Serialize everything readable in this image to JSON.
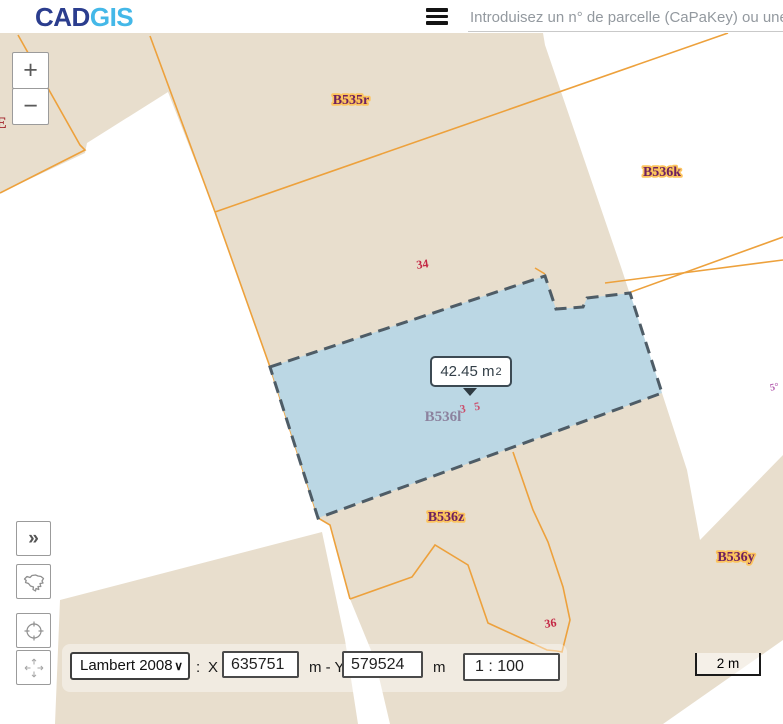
{
  "header": {
    "logo": {
      "part1": "CAD",
      "part2": "GIS"
    },
    "search": {
      "placeholder": "Introduisez un n° de parcelle (CaPaKey) ou une",
      "value": ""
    }
  },
  "map": {
    "colors": {
      "parcel_fill": "#e8decd",
      "boundary_line": "#eda13c",
      "selection_fill": "#b7d6e5",
      "selection_border": "#4e5c66",
      "parcel_label": "#6d2060",
      "parcel_label_halo": "#fcc45e",
      "house_number": "#c42845"
    },
    "parcel_labels": [
      {
        "text": "B535r"
      },
      {
        "text": "B536k"
      },
      {
        "text": "B536z"
      },
      {
        "text": "B536y"
      }
    ],
    "selected_parcel": {
      "label": "B536l",
      "tooltip": {
        "value": "42.45 m",
        "sup": "2"
      }
    },
    "house_numbers": [
      {
        "text": "34"
      },
      {
        "text": "3 5"
      },
      {
        "text": "36"
      },
      {
        "text": "5°"
      },
      {
        "text": "E"
      }
    ]
  },
  "controls": {
    "zoom_in": "+",
    "zoom_out": "−",
    "expand": "»"
  },
  "bottom_bar": {
    "crs": "Lambert 2008",
    "chevron": "∨",
    "colon": ":",
    "x_label": "X",
    "x_value": "635751",
    "y_label": "m - Y",
    "y_value": "579524",
    "unit": "m",
    "scale_value": "1 : 100"
  },
  "scale_bar": {
    "label": "2 m"
  }
}
